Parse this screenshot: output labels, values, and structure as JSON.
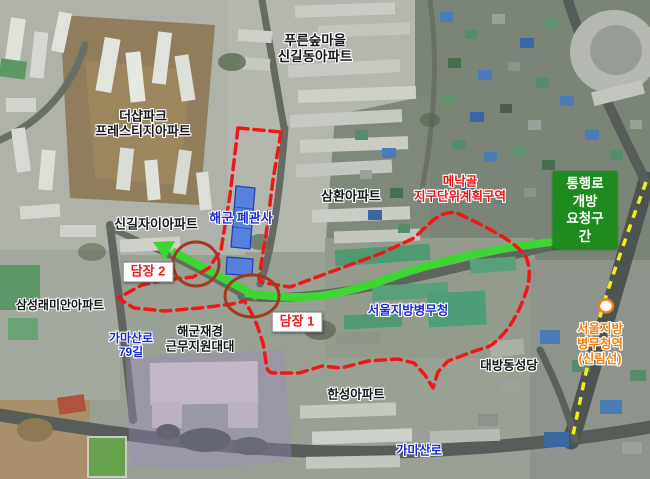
{
  "image": {
    "type": "annotated-satellite-map",
    "locale": "ko",
    "description": "Aerial map of Singil/Daebang area with redevelopment boundary and passage-opening request annotations"
  },
  "labels": {
    "pureun_forest_apt": "푸른숲마을\n신길동아파트",
    "the_sharp_prestige_apt": "더샵파크\n프레스티지아파트",
    "singil_xi_apt": "신길자이아파트",
    "samhwan_apt": "삼환아파트",
    "samsung_raemian_apt": "삼성래미안아파트",
    "navy_vacant_quarters": "해군 폐관사",
    "menakgol_district": "메낙골\n지구단위계획구역",
    "passage_open_request": "통행로 개방\n요청구간",
    "fence_2": "담장 2",
    "fence_1": "담장 1",
    "navy_support_battalion": "해군재경\n근무지원대대",
    "seoul_military_manpower_office": "서울지방병무청",
    "daebang_cathedral": "대방동성당",
    "hanseong_apt": "한성아파트",
    "gamasan_ro_79": "가마산로\n79길",
    "gamasan_ro": "가마산로",
    "station": "서울지방병무청역\n(신림선)"
  },
  "colors": {
    "boundary_red": "#ee1818",
    "arrow_green": "#3ed633",
    "request_box_green": "#1e8b1f",
    "fence_circle_dark_red": "#a23a1d",
    "railway_yellow": "#f4ee18",
    "label_blue": "#1b2ed4",
    "label_red": "#ea1515",
    "station_orange": "#f2820a",
    "station_marker_stroke": "#ef7d18",
    "highlight_building_blue": "#4c7ce0"
  },
  "markers": {
    "station_marker": "sillim-line-station",
    "fence_circles": [
      "fence-2-location",
      "fence-1-location"
    ],
    "highlighted_buildings": [
      "navy-vacant-quarters-main",
      "navy-vacant-quarters-annex"
    ]
  }
}
